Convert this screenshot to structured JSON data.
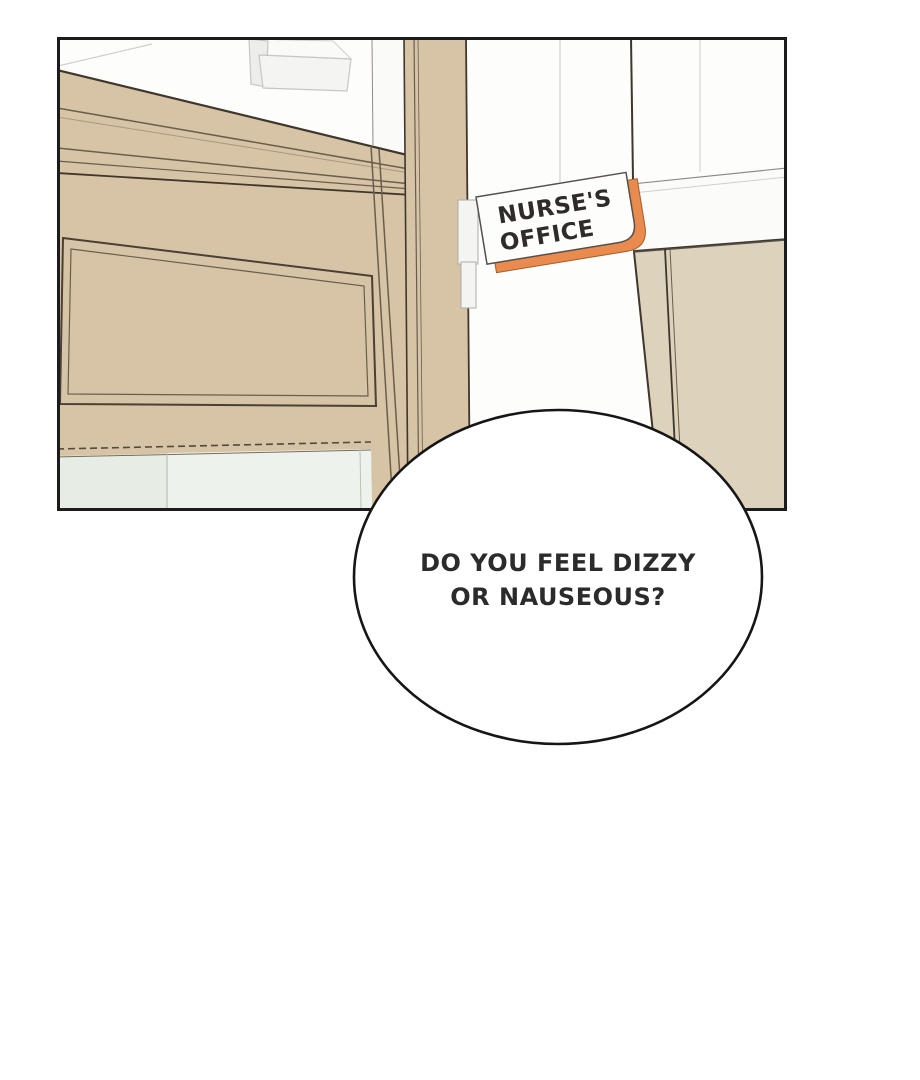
{
  "colors": {
    "panel_outline": "#1c1c1c",
    "door_beige": "#d7c4a7",
    "wall_beige": "#ddd2bb",
    "glass_left": "#e7ede5",
    "glass_right": "#eef2ec",
    "sign_orange": "#e98a4e",
    "bubble_outline": "#161616"
  },
  "panel": {
    "sign": {
      "line1": "NURSE'S",
      "line2": "OFFICE"
    }
  },
  "speech_bubble": {
    "line1": "DO YOU FEEL DIZZY",
    "line2": "OR NAUSEOUS?"
  }
}
